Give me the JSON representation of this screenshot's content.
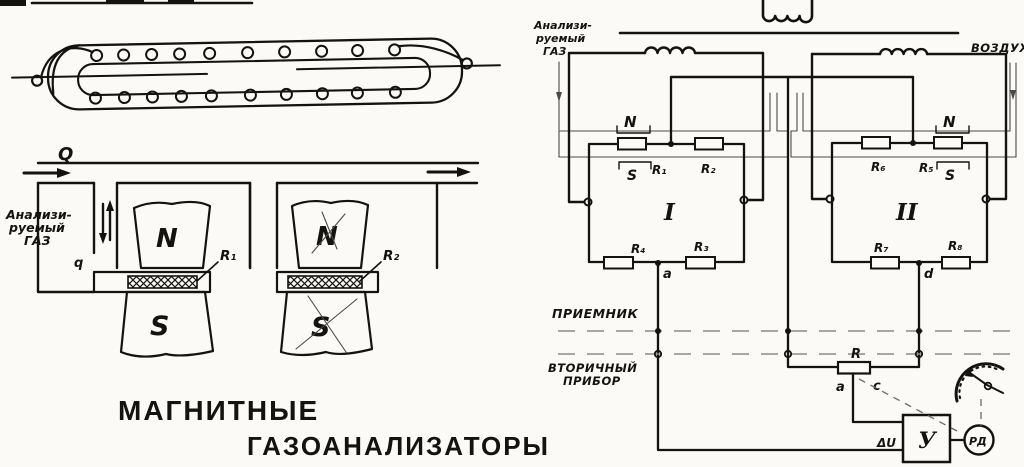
{
  "colors": {
    "ink": "#151310",
    "paper": "#fbfaf7",
    "thin_line": "#4a4a4a"
  },
  "left": {
    "flow_q": "Q",
    "gas_lines": [
      "Анализи-",
      "руемый",
      "ГАЗ"
    ],
    "bypass_q": "q",
    "magnet1": {
      "n": "N",
      "s": "S",
      "r": "R₁"
    },
    "magnet2": {
      "n": "N",
      "s": "S",
      "r": "R₂"
    },
    "title_line1": "МАГНИТНЫЕ",
    "title_line2": "ГАЗОАНАЛИЗАТОРЫ"
  },
  "right": {
    "gas_lines": [
      "Анализи-",
      "руемый",
      "ГАЗ"
    ],
    "air_label": "ВОЗДУХ",
    "bridge1": {
      "n": "N",
      "s": "S",
      "r1": "R₁",
      "r2": "R₂",
      "r3": "R₃",
      "r4": "R₄",
      "numeral": "I",
      "node": "a"
    },
    "bridge2": {
      "n": "N",
      "s": "S",
      "r5": "R₅",
      "r6": "R₆",
      "r7": "R₇",
      "r8": "R₈",
      "numeral": "II",
      "node": "d"
    },
    "receiver_label": "ПРИЕМНИК",
    "secondary_lines": [
      "ВТОРИЧНЫЙ",
      "ПРИБОР"
    ],
    "rheostat": {
      "label": "R",
      "term_a": "a",
      "term_c": "c"
    },
    "amplifier": {
      "input_label": "ΔU",
      "label": "У"
    },
    "motor_label": "РД"
  }
}
